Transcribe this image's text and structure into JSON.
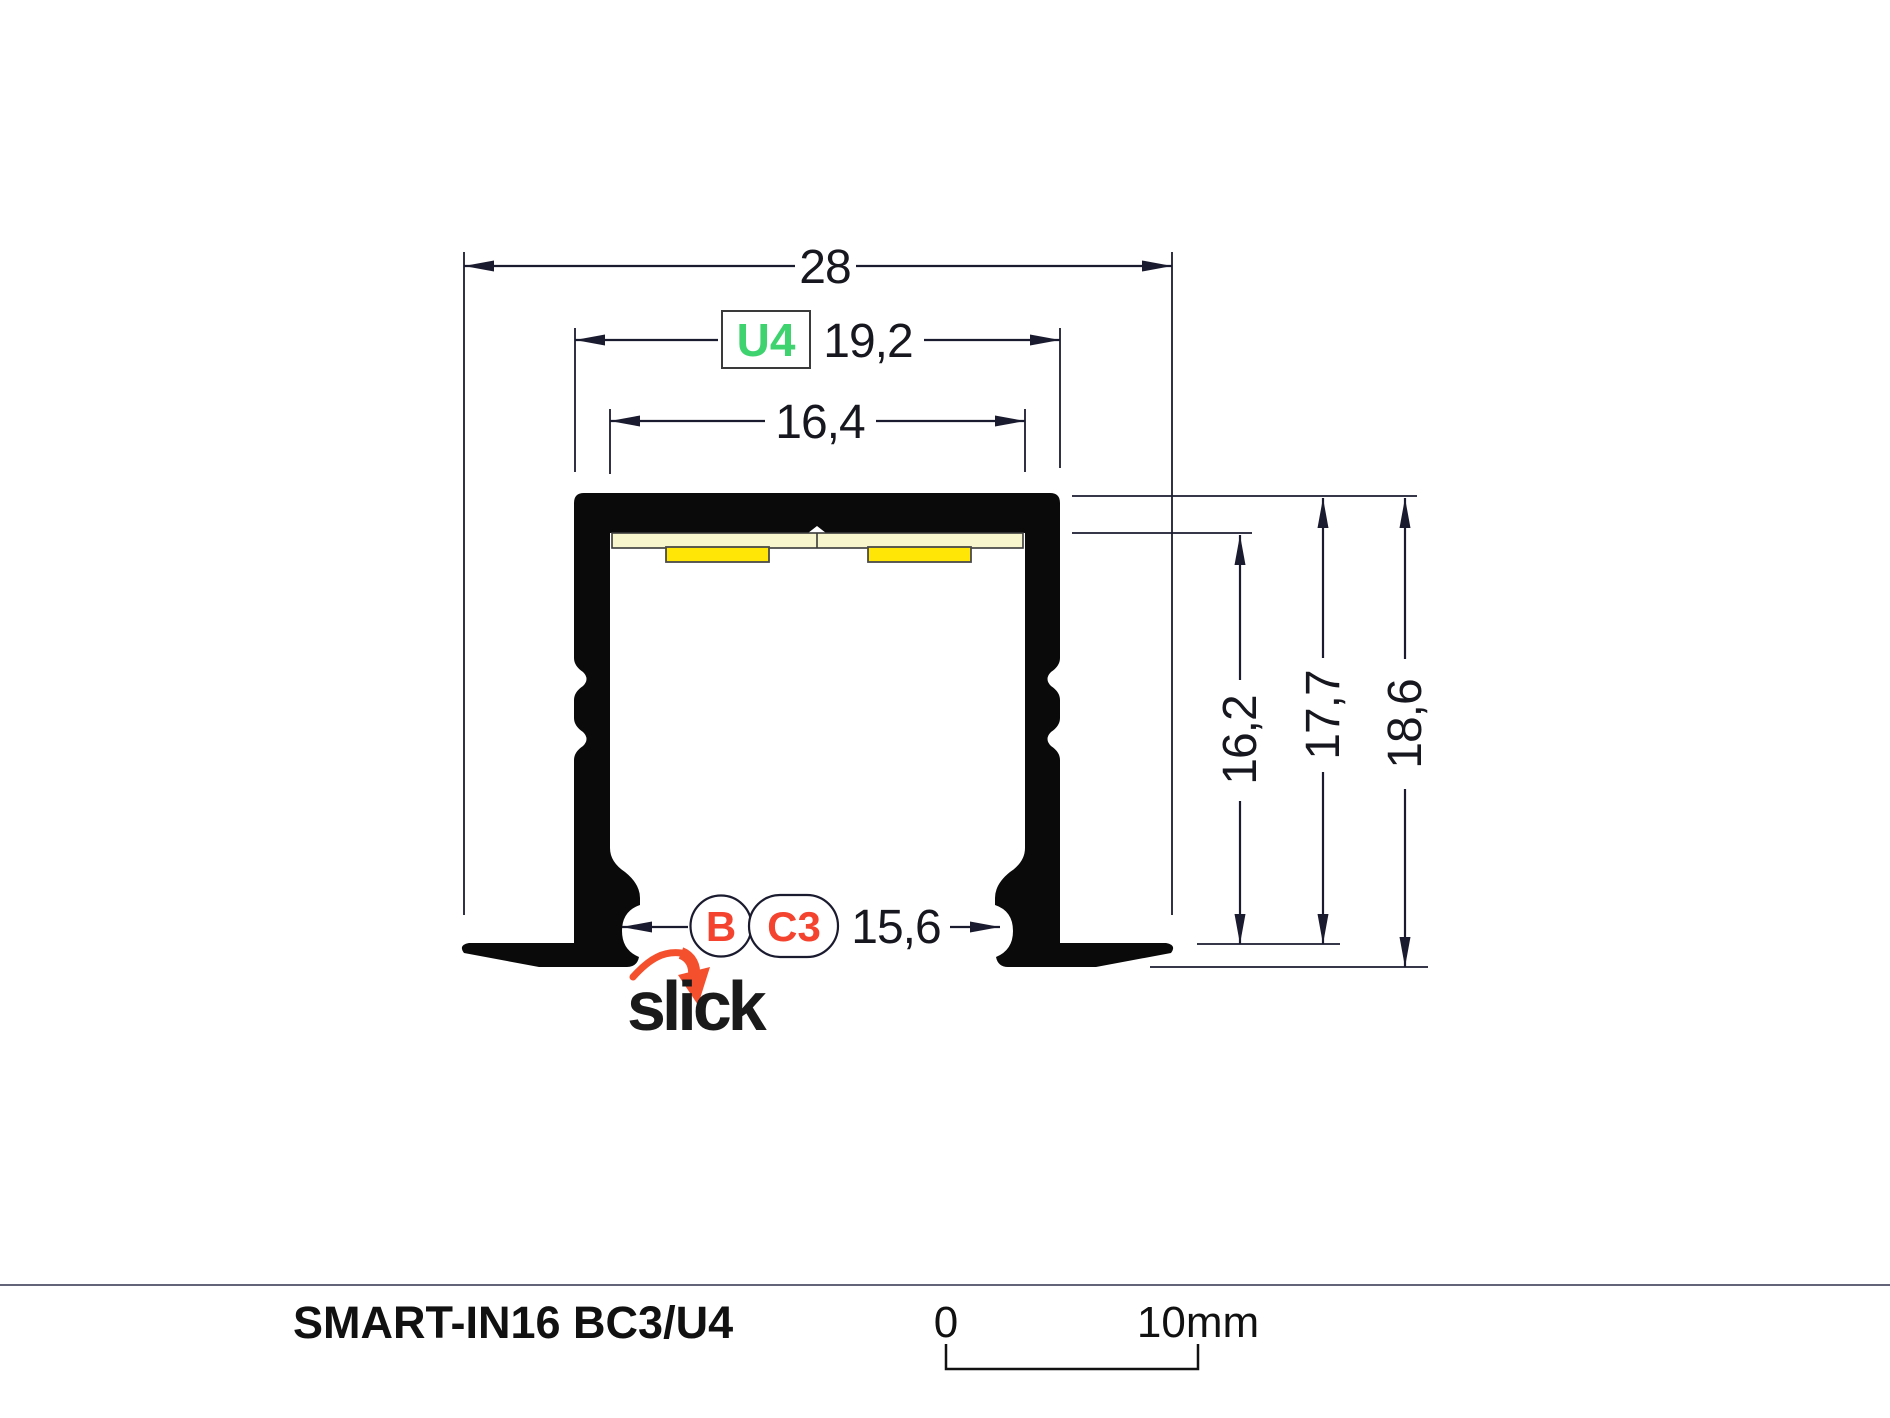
{
  "diagram": {
    "dimensions": {
      "total_width": "28",
      "u4_width": "19,2",
      "inner_width": "16,4",
      "inner_height": "16,2",
      "mid_height": "17,7",
      "total_height": "18,6",
      "opening_width": "15,6"
    },
    "variant_labels": {
      "u4": "U4",
      "b": "B",
      "c3": "C3"
    },
    "logo_text": "slick"
  },
  "footer": {
    "title": "SMART-IN16 BC3/U4",
    "scale_zero": "0",
    "scale_end": "10mm"
  },
  "colors": {
    "profile_black": "#0a0a0a",
    "dimension_line": "#1b1b30",
    "u4_green": "#3ed36e",
    "badge_red": "#f4432e",
    "logo_arrow_red": "#f4502e",
    "pcb_cream": "#f8f6cc",
    "led_yellow": "#ffe606",
    "separator_gray": "#63637a"
  }
}
